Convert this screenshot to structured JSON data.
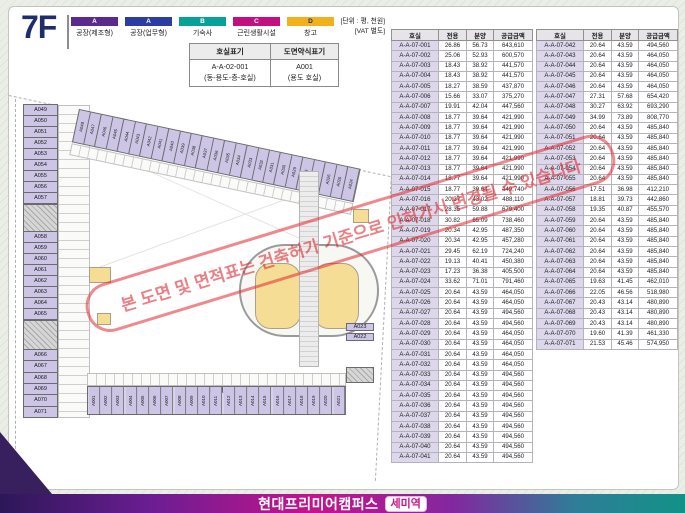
{
  "header": {
    "floor_label": "7F",
    "unit_note_line1": "[단위 : 평, 천원]",
    "unit_note_line2": "[VAT 별도]",
    "legend": [
      {
        "code": "A",
        "label": "공장(제조형)",
        "color": "#5b2a8c",
        "text": "#ffffff"
      },
      {
        "code": "A",
        "label": "공장(업무형)",
        "color": "#2b3da0",
        "text": "#ffffff"
      },
      {
        "code": "B",
        "label": "기숙사",
        "color": "#06a29a",
        "text": "#ffffff"
      },
      {
        "code": "C",
        "label": "근린생활시설",
        "color": "#c4107f",
        "text": "#ffffff"
      },
      {
        "code": "D",
        "label": "창고",
        "color": "#f2b01b",
        "text": "#1e2a5e"
      }
    ],
    "notation": {
      "col1_header": "호실표기",
      "col2_header": "도면약식표기",
      "col1_line1": "A-A-02-001",
      "col1_line2": "(동-용도-층-호실)",
      "col2_line1": "A001",
      "col2_line2": "(용도 호실)"
    }
  },
  "tables": {
    "columns": [
      "호실",
      "전용",
      "분양",
      "공급금액"
    ],
    "left_rows": [
      [
        "A-A-07-001",
        "26.86",
        "56.73",
        "643,610"
      ],
      [
        "A-A-07-002",
        "25.06",
        "52.93",
        "600,570"
      ],
      [
        "A-A-07-003",
        "18.43",
        "38.92",
        "441,570"
      ],
      [
        "A-A-07-004",
        "18.43",
        "38.92",
        "441,570"
      ],
      [
        "A-A-07-005",
        "18.27",
        "38.59",
        "437,870"
      ],
      [
        "A-A-07-006",
        "15.66",
        "33.07",
        "375,270"
      ],
      [
        "A-A-07-007",
        "19.91",
        "42.04",
        "447,560"
      ],
      [
        "A-A-07-008",
        "18.77",
        "39.64",
        "421,990"
      ],
      [
        "A-A-07-009",
        "18.77",
        "39.64",
        "421,990"
      ],
      [
        "A-A-07-010",
        "18.77",
        "39.64",
        "421,990"
      ],
      [
        "A-A-07-011",
        "18.77",
        "39.64",
        "421,990"
      ],
      [
        "A-A-07-012",
        "18.77",
        "39.64",
        "421,990"
      ],
      [
        "A-A-07-013",
        "18.77",
        "39.64",
        "421,990"
      ],
      [
        "A-A-07-014",
        "18.77",
        "39.64",
        "421,990"
      ],
      [
        "A-A-07-015",
        "18.77",
        "39.64",
        "449,740"
      ],
      [
        "A-A-07-016",
        "20.37",
        "43.02",
        "488,110"
      ],
      [
        "A-A-07-017",
        "28.35",
        "59.88",
        "679,400"
      ],
      [
        "A-A-07-018",
        "30.82",
        "65.09",
        "738,460"
      ],
      [
        "A-A-07-019",
        "20.34",
        "42.95",
        "487,350"
      ],
      [
        "A-A-07-020",
        "20.34",
        "42.95",
        "457,280"
      ],
      [
        "A-A-07-021",
        "29.45",
        "62.19",
        "724,240"
      ],
      [
        "A-A-07-022",
        "19.13",
        "40.41",
        "450,380"
      ],
      [
        "A-A-07-023",
        "17.23",
        "36.38",
        "405,500"
      ],
      [
        "A-A-07-024",
        "33.62",
        "71.01",
        "791,460"
      ],
      [
        "A-A-07-025",
        "20.64",
        "43.59",
        "464,050"
      ],
      [
        "A-A-07-026",
        "20.64",
        "43.59",
        "464,050"
      ],
      [
        "A-A-07-027",
        "20.64",
        "43.59",
        "494,560"
      ],
      [
        "A-A-07-028",
        "20.64",
        "43.59",
        "494,560"
      ],
      [
        "A-A-07-029",
        "20.64",
        "43.59",
        "464,050"
      ],
      [
        "A-A-07-030",
        "20.64",
        "43.59",
        "464,050"
      ],
      [
        "A-A-07-031",
        "20.64",
        "43.59",
        "464,050"
      ],
      [
        "A-A-07-032",
        "20.64",
        "43.59",
        "464,050"
      ],
      [
        "A-A-07-033",
        "20.64",
        "43.59",
        "494,560"
      ],
      [
        "A-A-07-034",
        "20.64",
        "43.59",
        "494,560"
      ],
      [
        "A-A-07-035",
        "20.64",
        "43.59",
        "494,560"
      ],
      [
        "A-A-07-036",
        "20.64",
        "43.59",
        "494,560"
      ],
      [
        "A-A-07-037",
        "20.64",
        "43.59",
        "494,560"
      ],
      [
        "A-A-07-038",
        "20.64",
        "43.59",
        "494,560"
      ],
      [
        "A-A-07-039",
        "20.64",
        "43.59",
        "494,560"
      ],
      [
        "A-A-07-040",
        "20.64",
        "43.59",
        "494,560"
      ],
      [
        "A-A-07-041",
        "20.64",
        "43.59",
        "494,560"
      ]
    ],
    "right_rows": [
      [
        "A-A-07-042",
        "20.64",
        "43.59",
        "494,560"
      ],
      [
        "A-A-07-043",
        "20.64",
        "43.59",
        "464,050"
      ],
      [
        "A-A-07-044",
        "20.64",
        "43.59",
        "464,050"
      ],
      [
        "A-A-07-045",
        "20.64",
        "43.59",
        "464,050"
      ],
      [
        "A-A-07-046",
        "20.64",
        "43.59",
        "464,050"
      ],
      [
        "A-A-07-047",
        "27.31",
        "57.68",
        "654,420"
      ],
      [
        "A-A-07-048",
        "30.27",
        "63.92",
        "693,290"
      ],
      [
        "A-A-07-049",
        "34.99",
        "73.89",
        "808,770"
      ],
      [
        "A-A-07-050",
        "20.64",
        "43.59",
        "485,840"
      ],
      [
        "A-A-07-051",
        "20.64",
        "43.59",
        "485,840"
      ],
      [
        "A-A-07-052",
        "20.64",
        "43.59",
        "485,840"
      ],
      [
        "A-A-07-053",
        "20.64",
        "43.59",
        "485,840"
      ],
      [
        "A-A-07-054",
        "20.64",
        "43.59",
        "485,840"
      ],
      [
        "A-A-07-055",
        "20.64",
        "43.59",
        "485,840"
      ],
      [
        "A-A-07-056",
        "17.51",
        "36.98",
        "412,210"
      ],
      [
        "A-A-07-057",
        "18.81",
        "39.73",
        "442,860"
      ],
      [
        "A-A-07-058",
        "19.35",
        "40.87",
        "455,570"
      ],
      [
        "A-A-07-059",
        "20.64",
        "43.59",
        "485,840"
      ],
      [
        "A-A-07-060",
        "20.64",
        "43.59",
        "485,840"
      ],
      [
        "A-A-07-061",
        "20.64",
        "43.59",
        "485,840"
      ],
      [
        "A-A-07-062",
        "20.64",
        "43.59",
        "485,840"
      ],
      [
        "A-A-07-063",
        "20.64",
        "43.59",
        "485,840"
      ],
      [
        "A-A-07-064",
        "20.64",
        "43.59",
        "485,840"
      ],
      [
        "A-A-07-065",
        "19.63",
        "41.45",
        "462,010"
      ],
      [
        "A-A-07-066",
        "22.05",
        "46.56",
        "518,980"
      ],
      [
        "A-A-07-067",
        "20.43",
        "43.14",
        "480,890"
      ],
      [
        "A-A-07-068",
        "20.43",
        "43.14",
        "480,890"
      ],
      [
        "A-A-07-069",
        "20.43",
        "43.14",
        "480,890"
      ],
      [
        "A-A-07-070",
        "19.60",
        "41.39",
        "461,330"
      ],
      [
        "A-A-07-071",
        "21.53",
        "45.46",
        "574,950"
      ]
    ]
  },
  "plan": {
    "left_wing_top": [
      "A049",
      "A050",
      "A051",
      "A052",
      "A053",
      "A054",
      "A055",
      "A056",
      "A057"
    ],
    "left_wing_mid": [
      "A058",
      "A059",
      "A060",
      "A061",
      "A062",
      "A063",
      "A064",
      "A065"
    ],
    "left_wing_bottom": [
      "A066",
      "A067",
      "A068",
      "A069",
      "A070",
      "A071"
    ],
    "diagonal_wing": [
      "A048",
      "A047",
      "A046",
      "A045",
      "A044",
      "A043",
      "A042",
      "A041",
      "A040",
      "A039",
      "A038",
      "A037",
      "A036",
      "A035",
      "A034",
      "A033",
      "A032",
      "A031",
      "A030",
      "A029",
      "A028",
      "A027",
      "A026",
      "A025",
      "A024"
    ],
    "bottom_wing": [
      "A001",
      "A002",
      "A003",
      "A004",
      "A005",
      "A006",
      "A007",
      "A008",
      "A009",
      "A010",
      "A011",
      "A012",
      "A013",
      "A014",
      "A015",
      "A016",
      "A017",
      "A018",
      "A019",
      "A020",
      "A021"
    ],
    "right_stack": [
      "A023",
      "A022"
    ]
  },
  "watermark": {
    "text": "본 도면 및 면적표는 건축허가 기준으로 인허가시 변경될 수 있습니다"
  },
  "footer": {
    "brand": "현대프리미어캠퍼스",
    "badge": "세미역"
  },
  "colors": {
    "room_fill": "#cdc5e5",
    "storage_fill": "#f6dd96",
    "accent_magenta": "#c4148c",
    "bar_gradient_left": "#2c1758",
    "bar_gradient_right": "#129287",
    "title_navy": "#1f2d6b"
  }
}
